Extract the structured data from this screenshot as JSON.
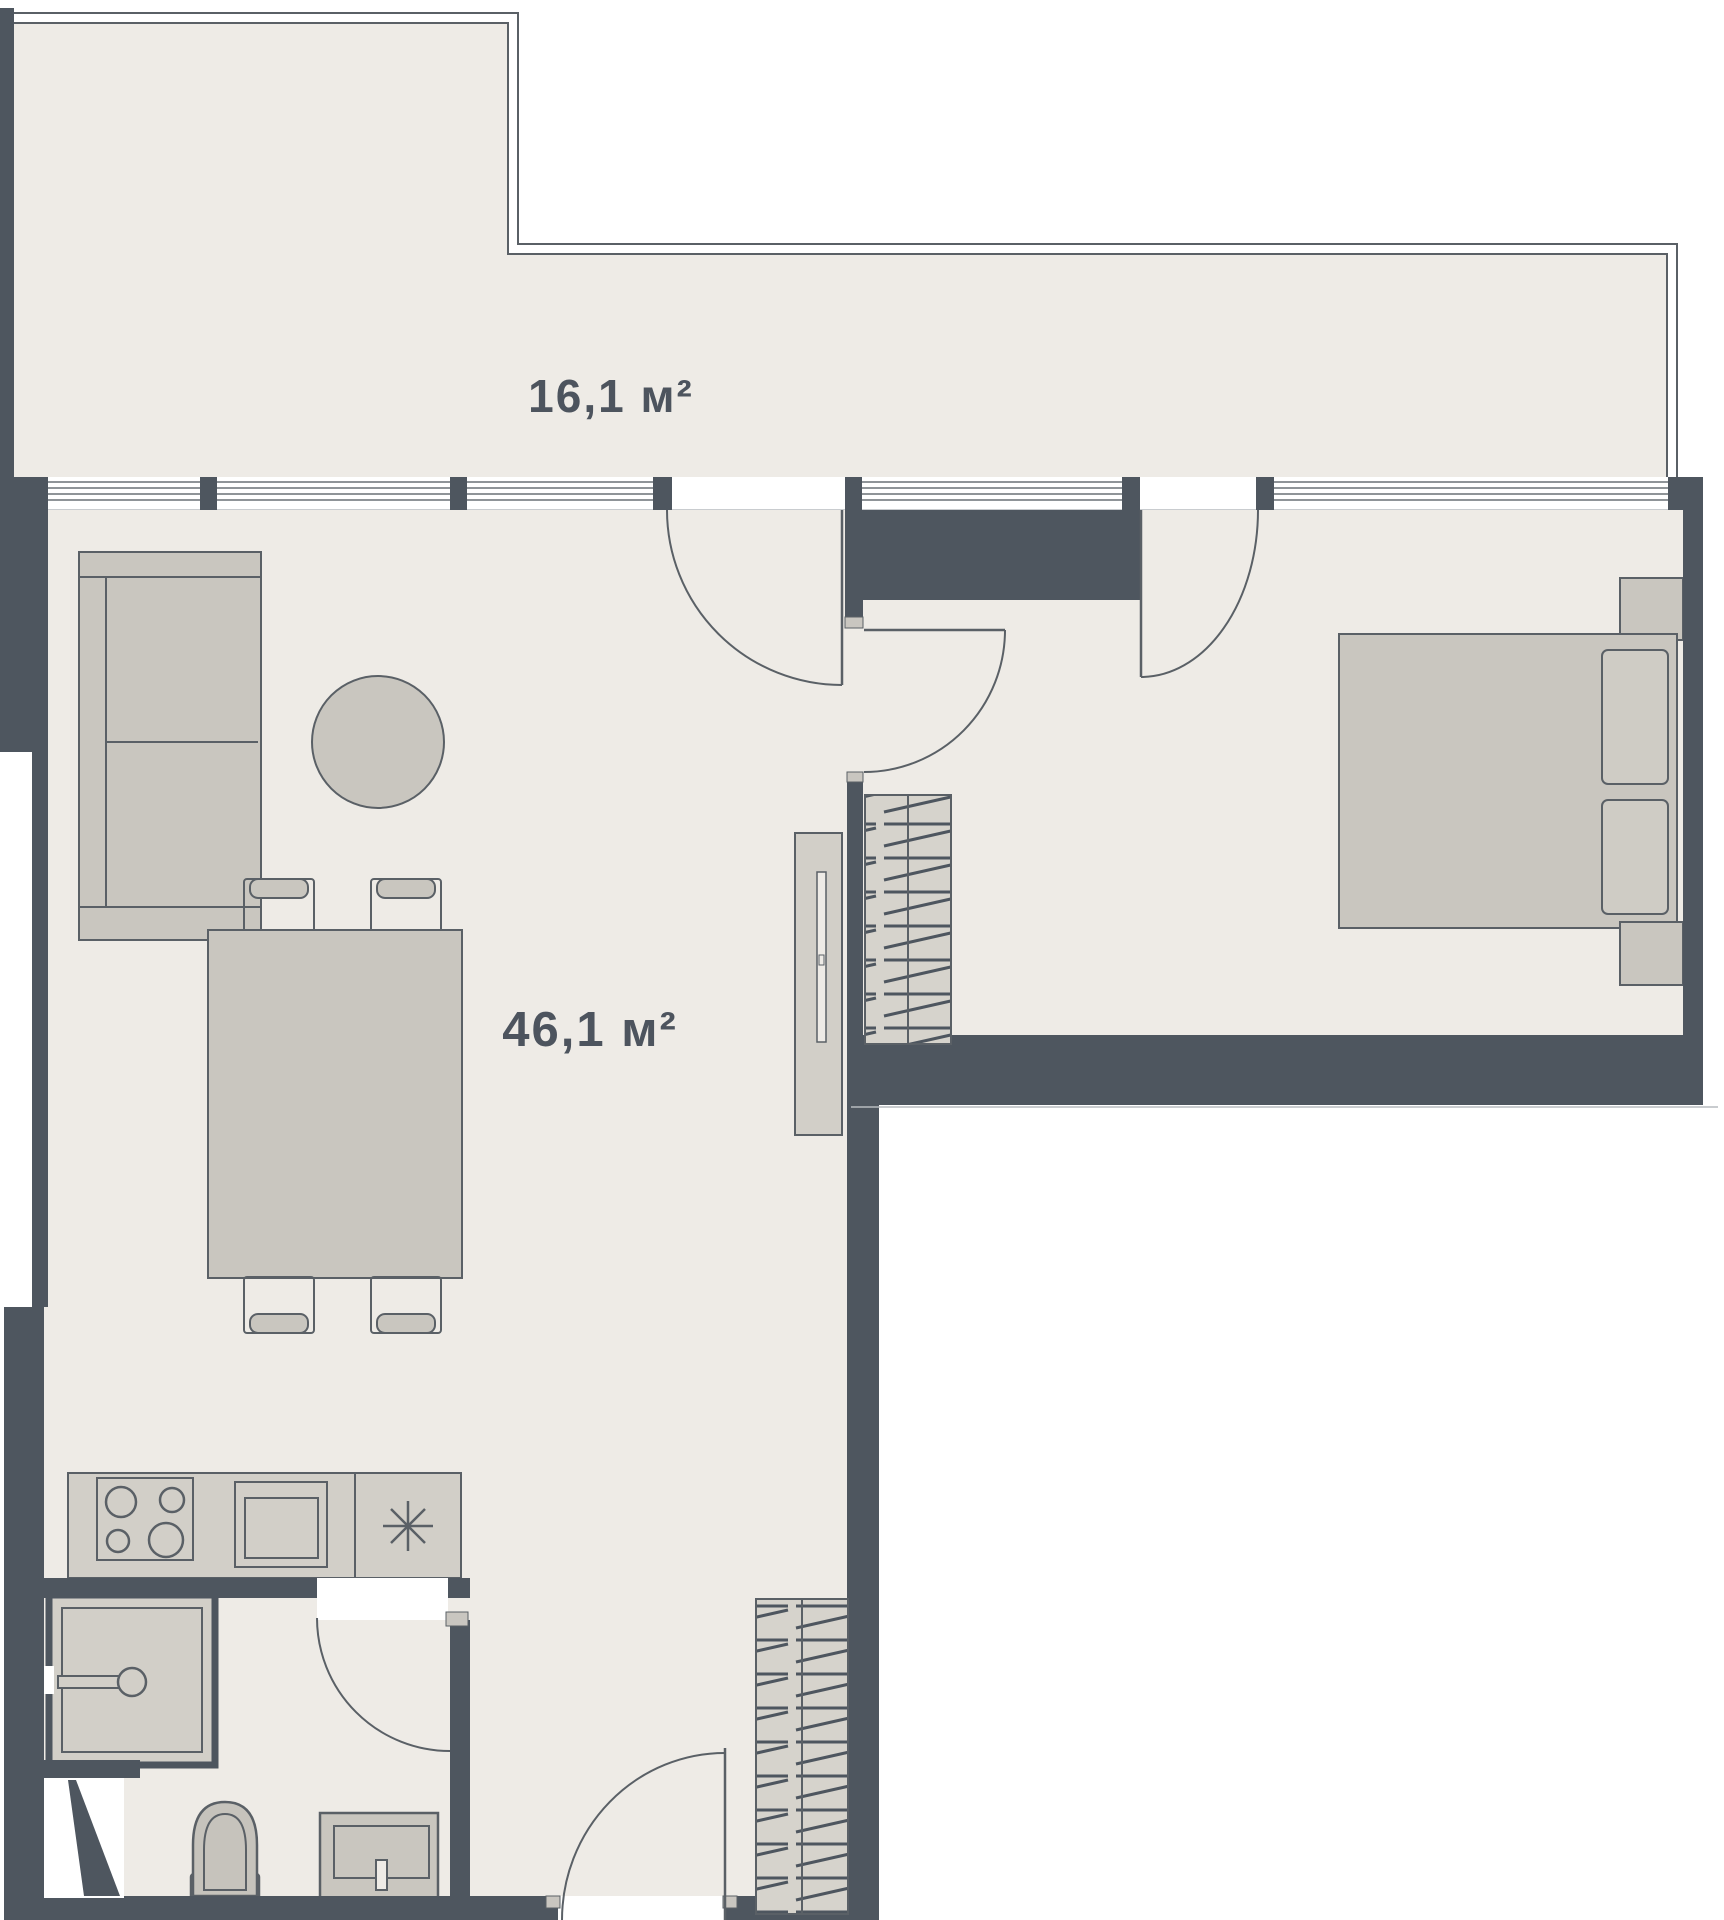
{
  "plan": {
    "name": "apartment-floor-plan",
    "rooms": {
      "terrace": {
        "area_label": "16,1 м²"
      },
      "living": {
        "area_label": "46,1 м²"
      }
    },
    "fixtures": [
      "sofa",
      "coffee-table",
      "dining-table",
      "chairs",
      "kitchen-counter",
      "stove",
      "kitchen-sink",
      "fridge-asterisk",
      "tv-panel",
      "wardrobe",
      "entrance-wardrobe",
      "bed",
      "pillows",
      "nightstands",
      "shower",
      "toilet",
      "vanity-sink",
      "vent-shaft"
    ]
  },
  "theme": {
    "background": "#ffffff",
    "wall": "#4e565f",
    "line": "#5a6066",
    "floor": "#eeebe6",
    "furniture": "#c9c6bf",
    "furniture_light": "#d2cfc8",
    "hatch_fill": "#d6d3cc",
    "cap": "#c9c6c0",
    "glass_line": "#6a7076",
    "hairline": "#b7bbbf",
    "label": "#4d545e"
  }
}
